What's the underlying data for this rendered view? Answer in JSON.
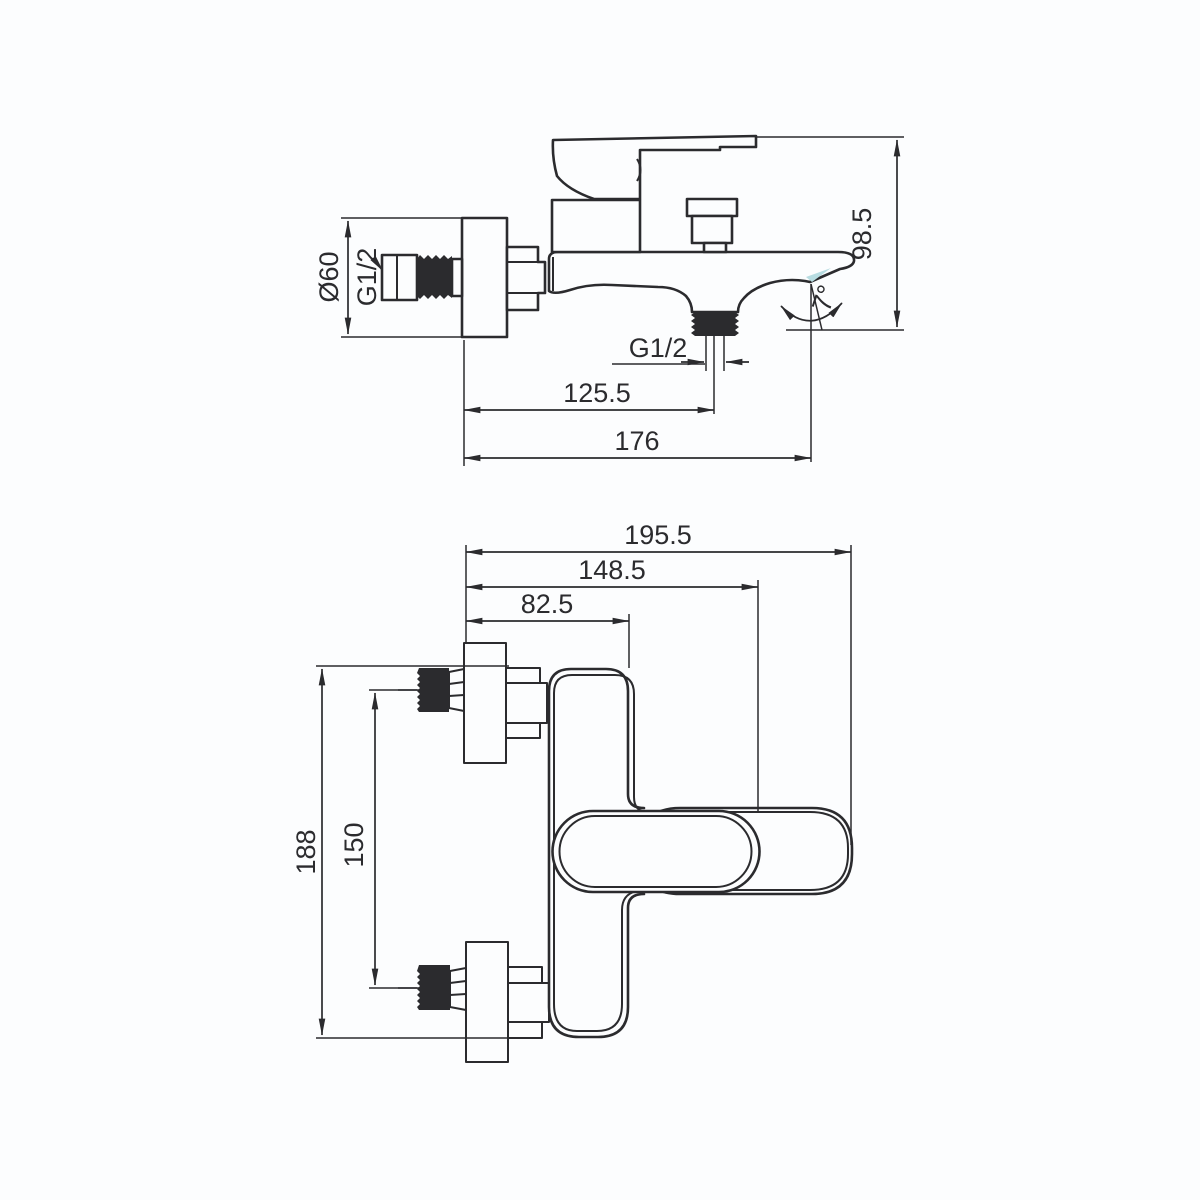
{
  "drawing": {
    "type": "technical-dimension-drawing",
    "subject": "wall-mounted bath mixer faucet, two orthographic views",
    "background_color": "#fcfdfe",
    "line_color": "#2b2b2e",
    "aerator_accent_color": "#b7dce1",
    "side_view": {
      "dim_escutcheon_diameter": "Ø60",
      "dim_inlet_thread": "G1/2",
      "dim_height": "98.5",
      "dim_outlet_thread": "G1/2",
      "dim_outlet_offset": "125.5",
      "dim_total_length": "176",
      "dim_spout_angle": "7°"
    },
    "front_view": {
      "dim_total_width": "195.5",
      "dim_handle_width": "148.5",
      "dim_body_width": "82.5",
      "dim_total_height": "188",
      "dim_inlet_spacing": "150"
    }
  }
}
